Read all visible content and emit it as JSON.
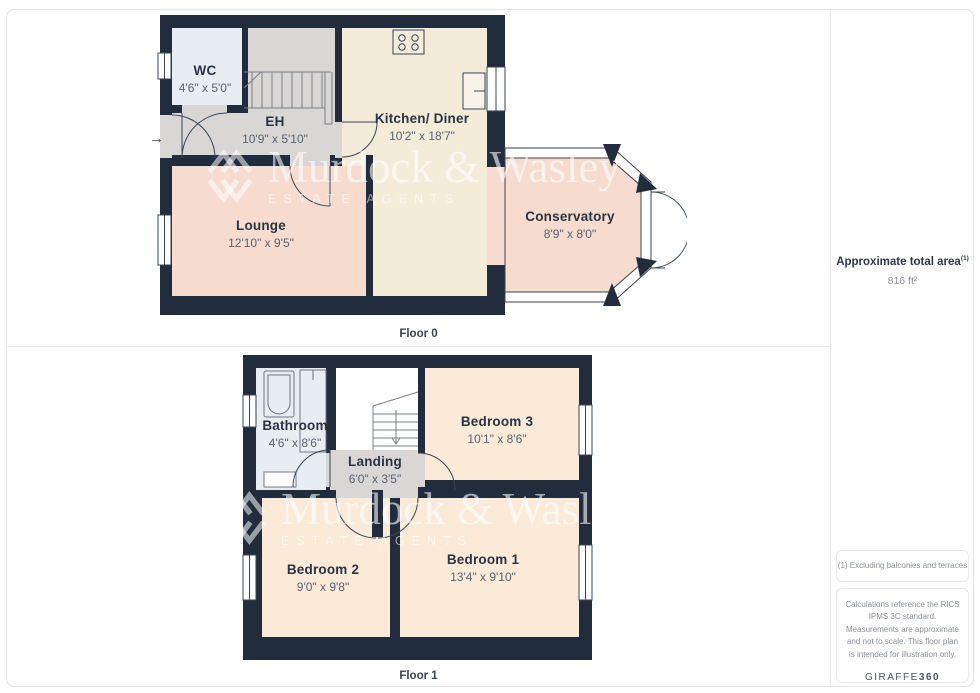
{
  "floors": [
    {
      "label": "Floor 0",
      "rooms": [
        {
          "name": "WC",
          "dims": "4'6\" x 5'0\""
        },
        {
          "name": "EH",
          "dims": "10'9\" x 5'10\""
        },
        {
          "name": "Kitchen/ Diner",
          "dims": "10'2\" x 18'7\""
        },
        {
          "name": "Lounge",
          "dims": "12'10\" x 9'5\""
        },
        {
          "name": "Conservatory",
          "dims": "8'9\" x 8'0\""
        }
      ]
    },
    {
      "label": "Floor 1",
      "rooms": [
        {
          "name": "Bathroom",
          "dims": "4'6\" x 8'6\""
        },
        {
          "name": "Landing",
          "dims": "6'0\" x 3'5\""
        },
        {
          "name": "Bedroom 3",
          "dims": "10'1\" x 8'6\""
        },
        {
          "name": "Bedroom 2",
          "dims": "9'0\" x 9'8\""
        },
        {
          "name": "Bedroom 1",
          "dims": "13'4\" x 9'10\""
        }
      ]
    }
  ],
  "watermark": {
    "name": "Murdock & Wasley",
    "tagline": "ESTATE AGENTS"
  },
  "icons": {
    "entry_arrow": "→"
  },
  "sidebar": {
    "area_title": "Approximate total area",
    "area_note_ref": "(1)",
    "area_value": "816 ft²",
    "footnote": "(1) Excluding balconies and terraces",
    "disclaimer": "Calculations reference the RICS IPMS 3C standard. Measurements are approximate and not to scale. This floor plan is intended for illustration only.",
    "brand": "GIRAFFE",
    "brand_suffix": "360"
  },
  "colors": {
    "wall": "#212c3c",
    "kitchen_floor": "#f2ecd9",
    "lounge_floor": "#f5dccf",
    "bedroom_floor": "#fbead7",
    "hall_floor": "#d8d7d5",
    "bathroom_floor": "#e8edf4",
    "line": "#3a4556",
    "divider": "#ececec"
  }
}
